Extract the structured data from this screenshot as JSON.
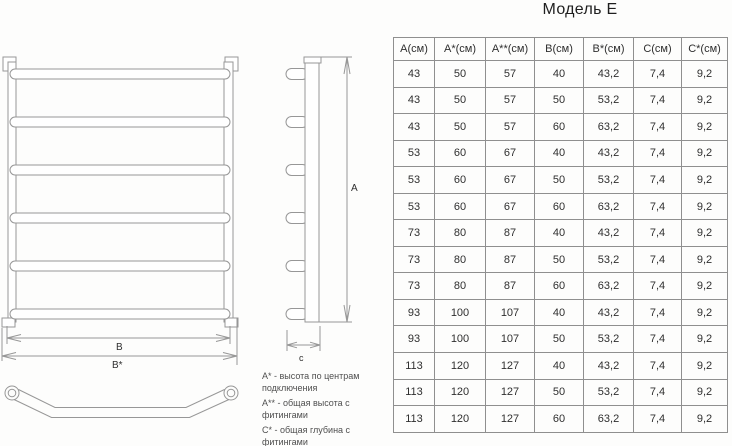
{
  "title": "Модель Е",
  "drawing": {
    "labels": {
      "a": "A",
      "b": "B",
      "b_star": "B*",
      "c": "с"
    }
  },
  "legend": {
    "items": [
      "А* - высота по центрам подключения",
      "А** - общая высота с фитингами",
      "С* - общая глубина с фитингами"
    ]
  },
  "table": {
    "headers": [
      "А(см)",
      "А*(см)",
      "А**(см)",
      "В(см)",
      "В*(см)",
      "С(см)",
      "С*(см)"
    ],
    "rows": [
      [
        "43",
        "50",
        "57",
        "40",
        "43,2",
        "7,4",
        "9,2"
      ],
      [
        "43",
        "50",
        "57",
        "50",
        "53,2",
        "7,4",
        "9,2"
      ],
      [
        "43",
        "50",
        "57",
        "60",
        "63,2",
        "7,4",
        "9,2"
      ],
      [
        "53",
        "60",
        "67",
        "40",
        "43,2",
        "7,4",
        "9,2"
      ],
      [
        "53",
        "60",
        "67",
        "50",
        "53,2",
        "7,4",
        "9,2"
      ],
      [
        "53",
        "60",
        "67",
        "60",
        "63,2",
        "7,4",
        "9,2"
      ],
      [
        "73",
        "80",
        "87",
        "40",
        "43,2",
        "7,4",
        "9,2"
      ],
      [
        "73",
        "80",
        "87",
        "50",
        "53,2",
        "7,4",
        "9,2"
      ],
      [
        "73",
        "80",
        "87",
        "60",
        "63,2",
        "7,4",
        "9,2"
      ],
      [
        "93",
        "100",
        "107",
        "40",
        "43,2",
        "7,4",
        "9,2"
      ],
      [
        "93",
        "100",
        "107",
        "50",
        "53,2",
        "7,4",
        "9,2"
      ],
      [
        "113",
        "120",
        "127",
        "40",
        "43,2",
        "7,4",
        "9,2"
      ],
      [
        "113",
        "120",
        "127",
        "50",
        "53,2",
        "7,4",
        "9,2"
      ],
      [
        "113",
        "120",
        "127",
        "60",
        "63,2",
        "7,4",
        "9,2"
      ]
    ]
  },
  "colors": {
    "background": "#fdfdfc",
    "line": "#979797",
    "table_border": "#8f8f8f",
    "text": "#2f2f2f",
    "secondary_text": "#4f4f4f"
  }
}
